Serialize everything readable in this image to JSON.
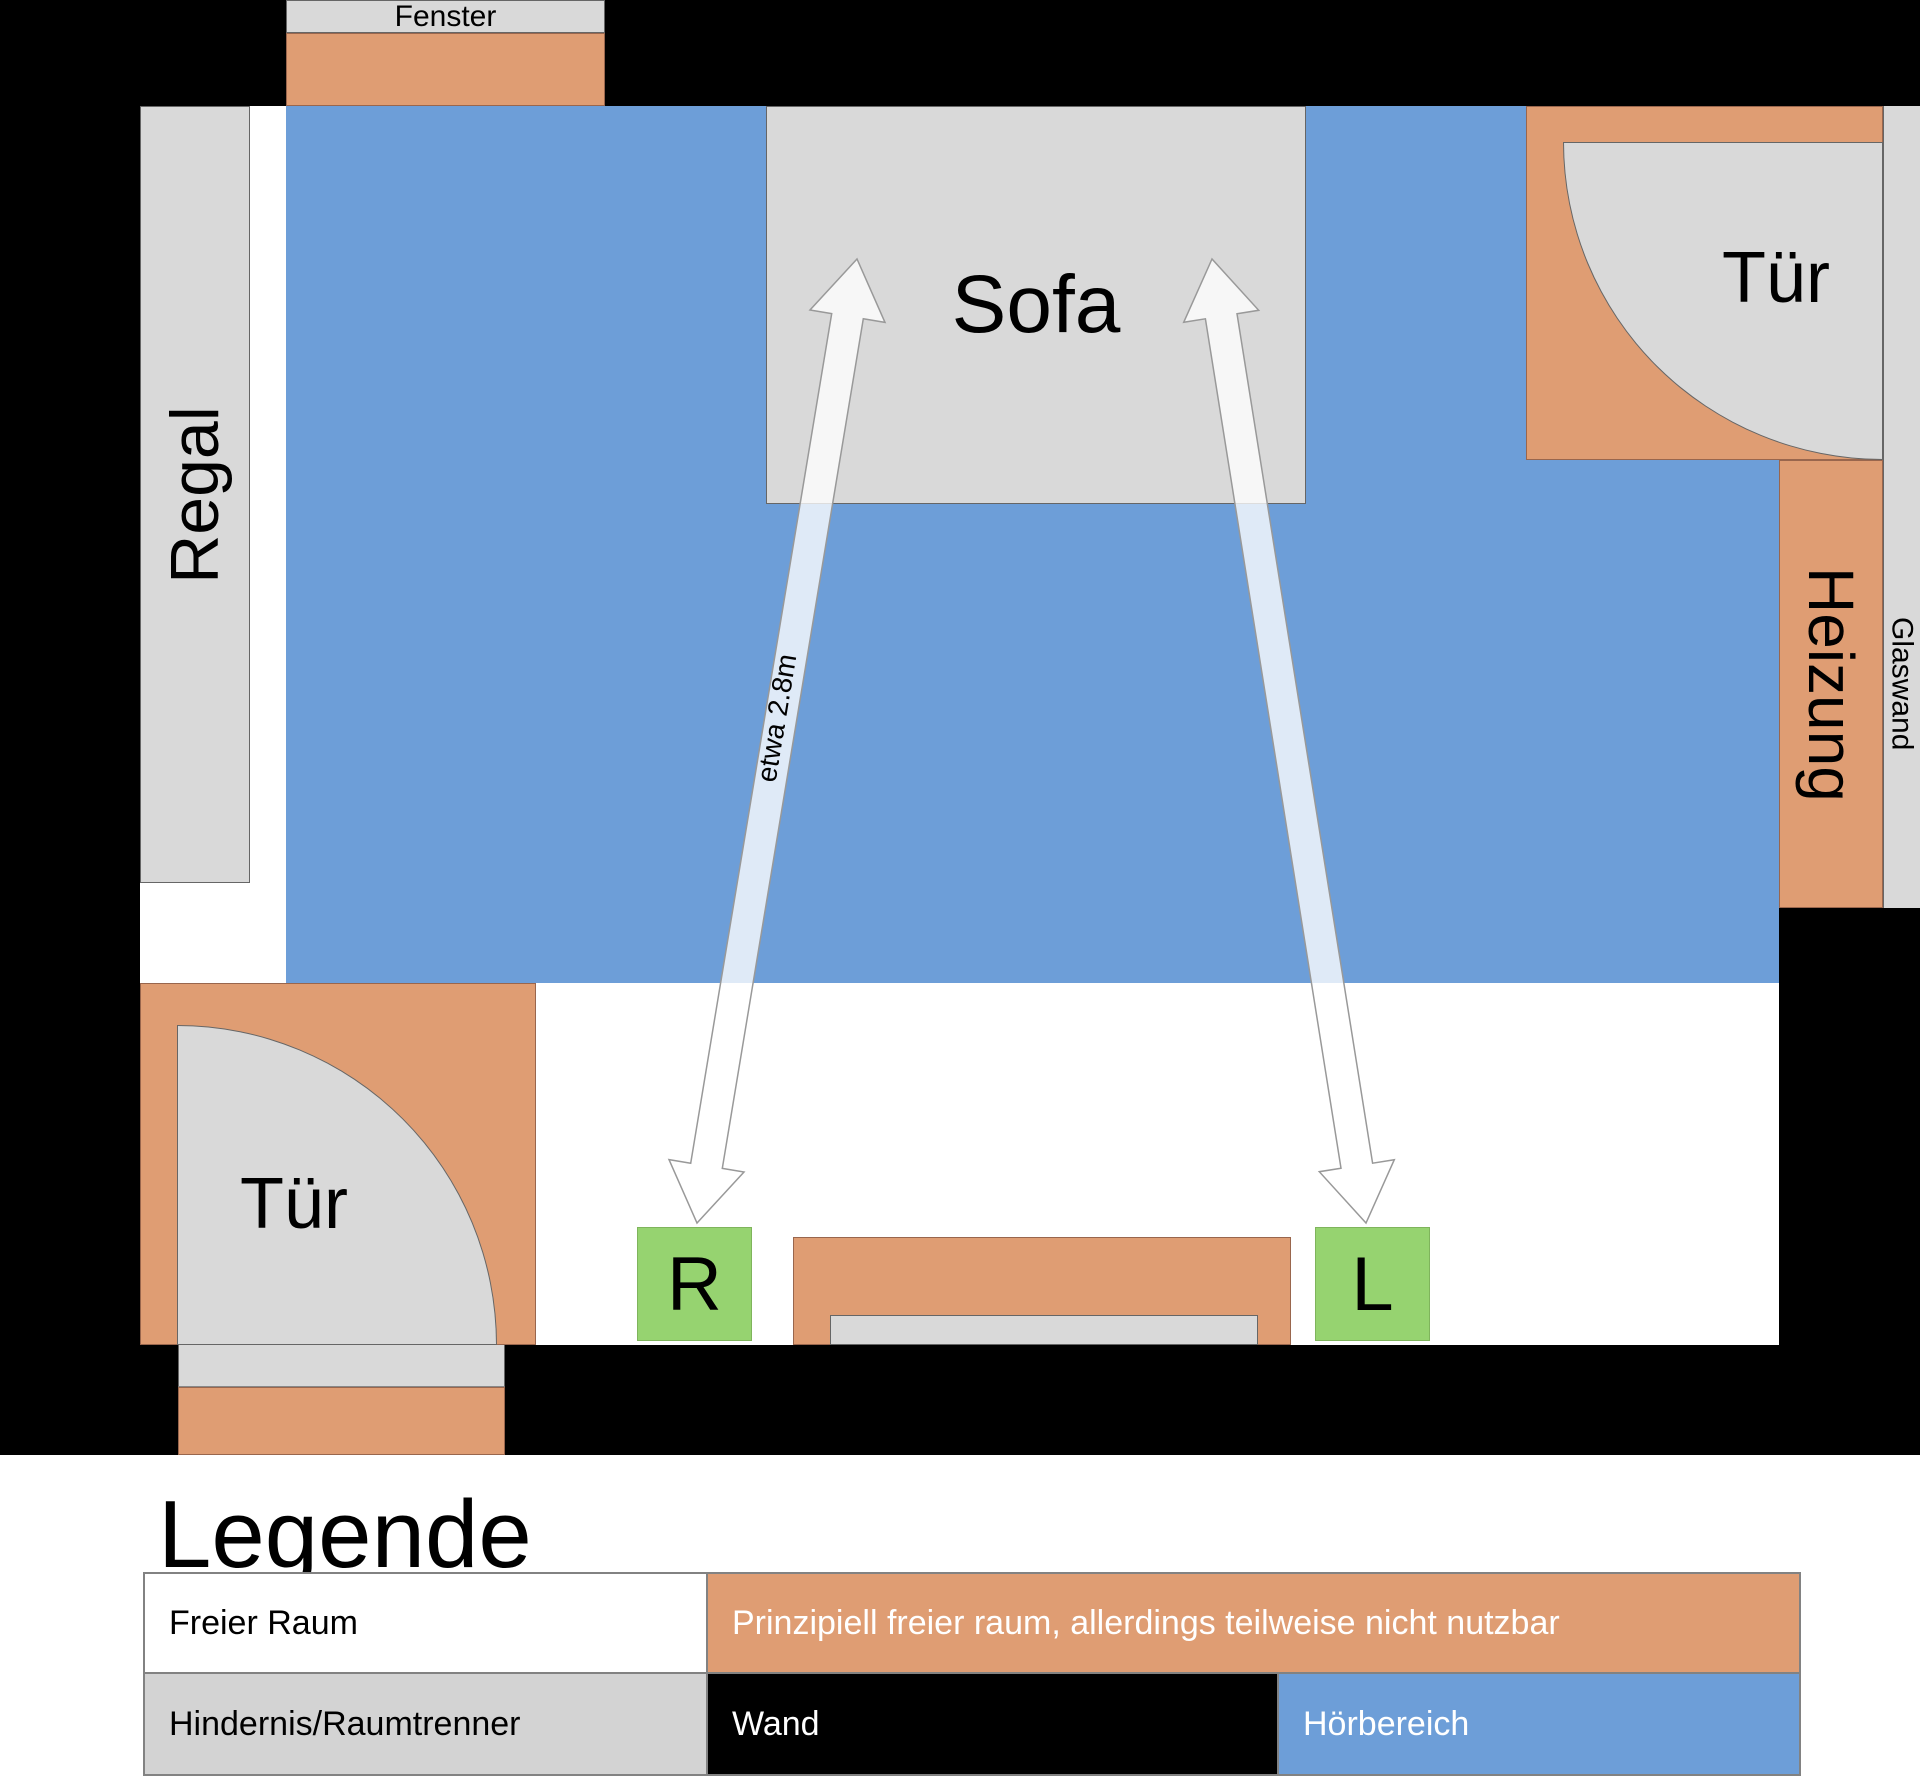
{
  "plan": {
    "window_label": "Fenster",
    "shelf_label": "Regal",
    "sofa_label": "Sofa",
    "door_label_top": "Tür",
    "door_label_bottom": "Tür",
    "heater_label": "Heizung",
    "glass_wall_label": "Glaswand",
    "speaker_right_label": "R",
    "speaker_left_label": "L",
    "distance_label": "etwa 2.8m"
  },
  "legend": {
    "title": "Legende",
    "rows": [
      {
        "cells": [
          {
            "label": "Freier Raum",
            "color": "#ffffff"
          },
          {
            "label": "Prinzipiell freier raum, allerdings teilweise nicht nutzbar",
            "color": "#df9d73"
          }
        ]
      },
      {
        "cells": [
          {
            "label": "Hindernis/Raumtrenner",
            "color": "#d3d3d3"
          },
          {
            "label": "Wand",
            "color": "#000000"
          },
          {
            "label": "Hörbereich",
            "color": "#6d9ed8"
          }
        ]
      }
    ]
  },
  "colors": {
    "wall": "#000000",
    "free_room": "#ffffff",
    "restricted_free_room": "#df9d73",
    "obstacle": "#d9d9d9",
    "listening_area": "#6d9ed8",
    "speaker": "#96d370",
    "arrow_fill": "rgba(255,255,255,0.78)",
    "arrow_stroke": "#999999"
  }
}
